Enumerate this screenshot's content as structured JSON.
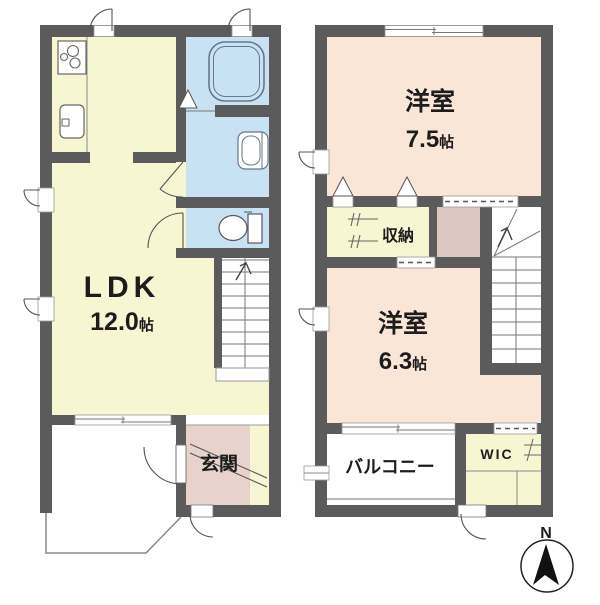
{
  "floor1": {
    "ldk": {
      "label": "LDK",
      "size": "12.0",
      "unit": "帖"
    },
    "genkan": {
      "label": "玄関"
    }
  },
  "floor2": {
    "room_75": {
      "label": "洋室",
      "size": "7.5",
      "unit": "帖"
    },
    "storage": {
      "label": "収納"
    },
    "room_63": {
      "label": "洋室",
      "size": "6.3",
      "unit": "帖"
    },
    "balcony": {
      "label": "バルコニー"
    },
    "wic": {
      "label": "WIC"
    }
  },
  "compass": {
    "label": "N"
  },
  "colors": {
    "wall": "#5b5b5b",
    "room_cream": "#f8f5d2",
    "room_blue": "#c8e2f3",
    "room_peach": "#fbe5d7",
    "genkan_pink": "#e8d3cc",
    "landing_mauve": "#dcc6c0",
    "fixture_line": "#667788"
  }
}
